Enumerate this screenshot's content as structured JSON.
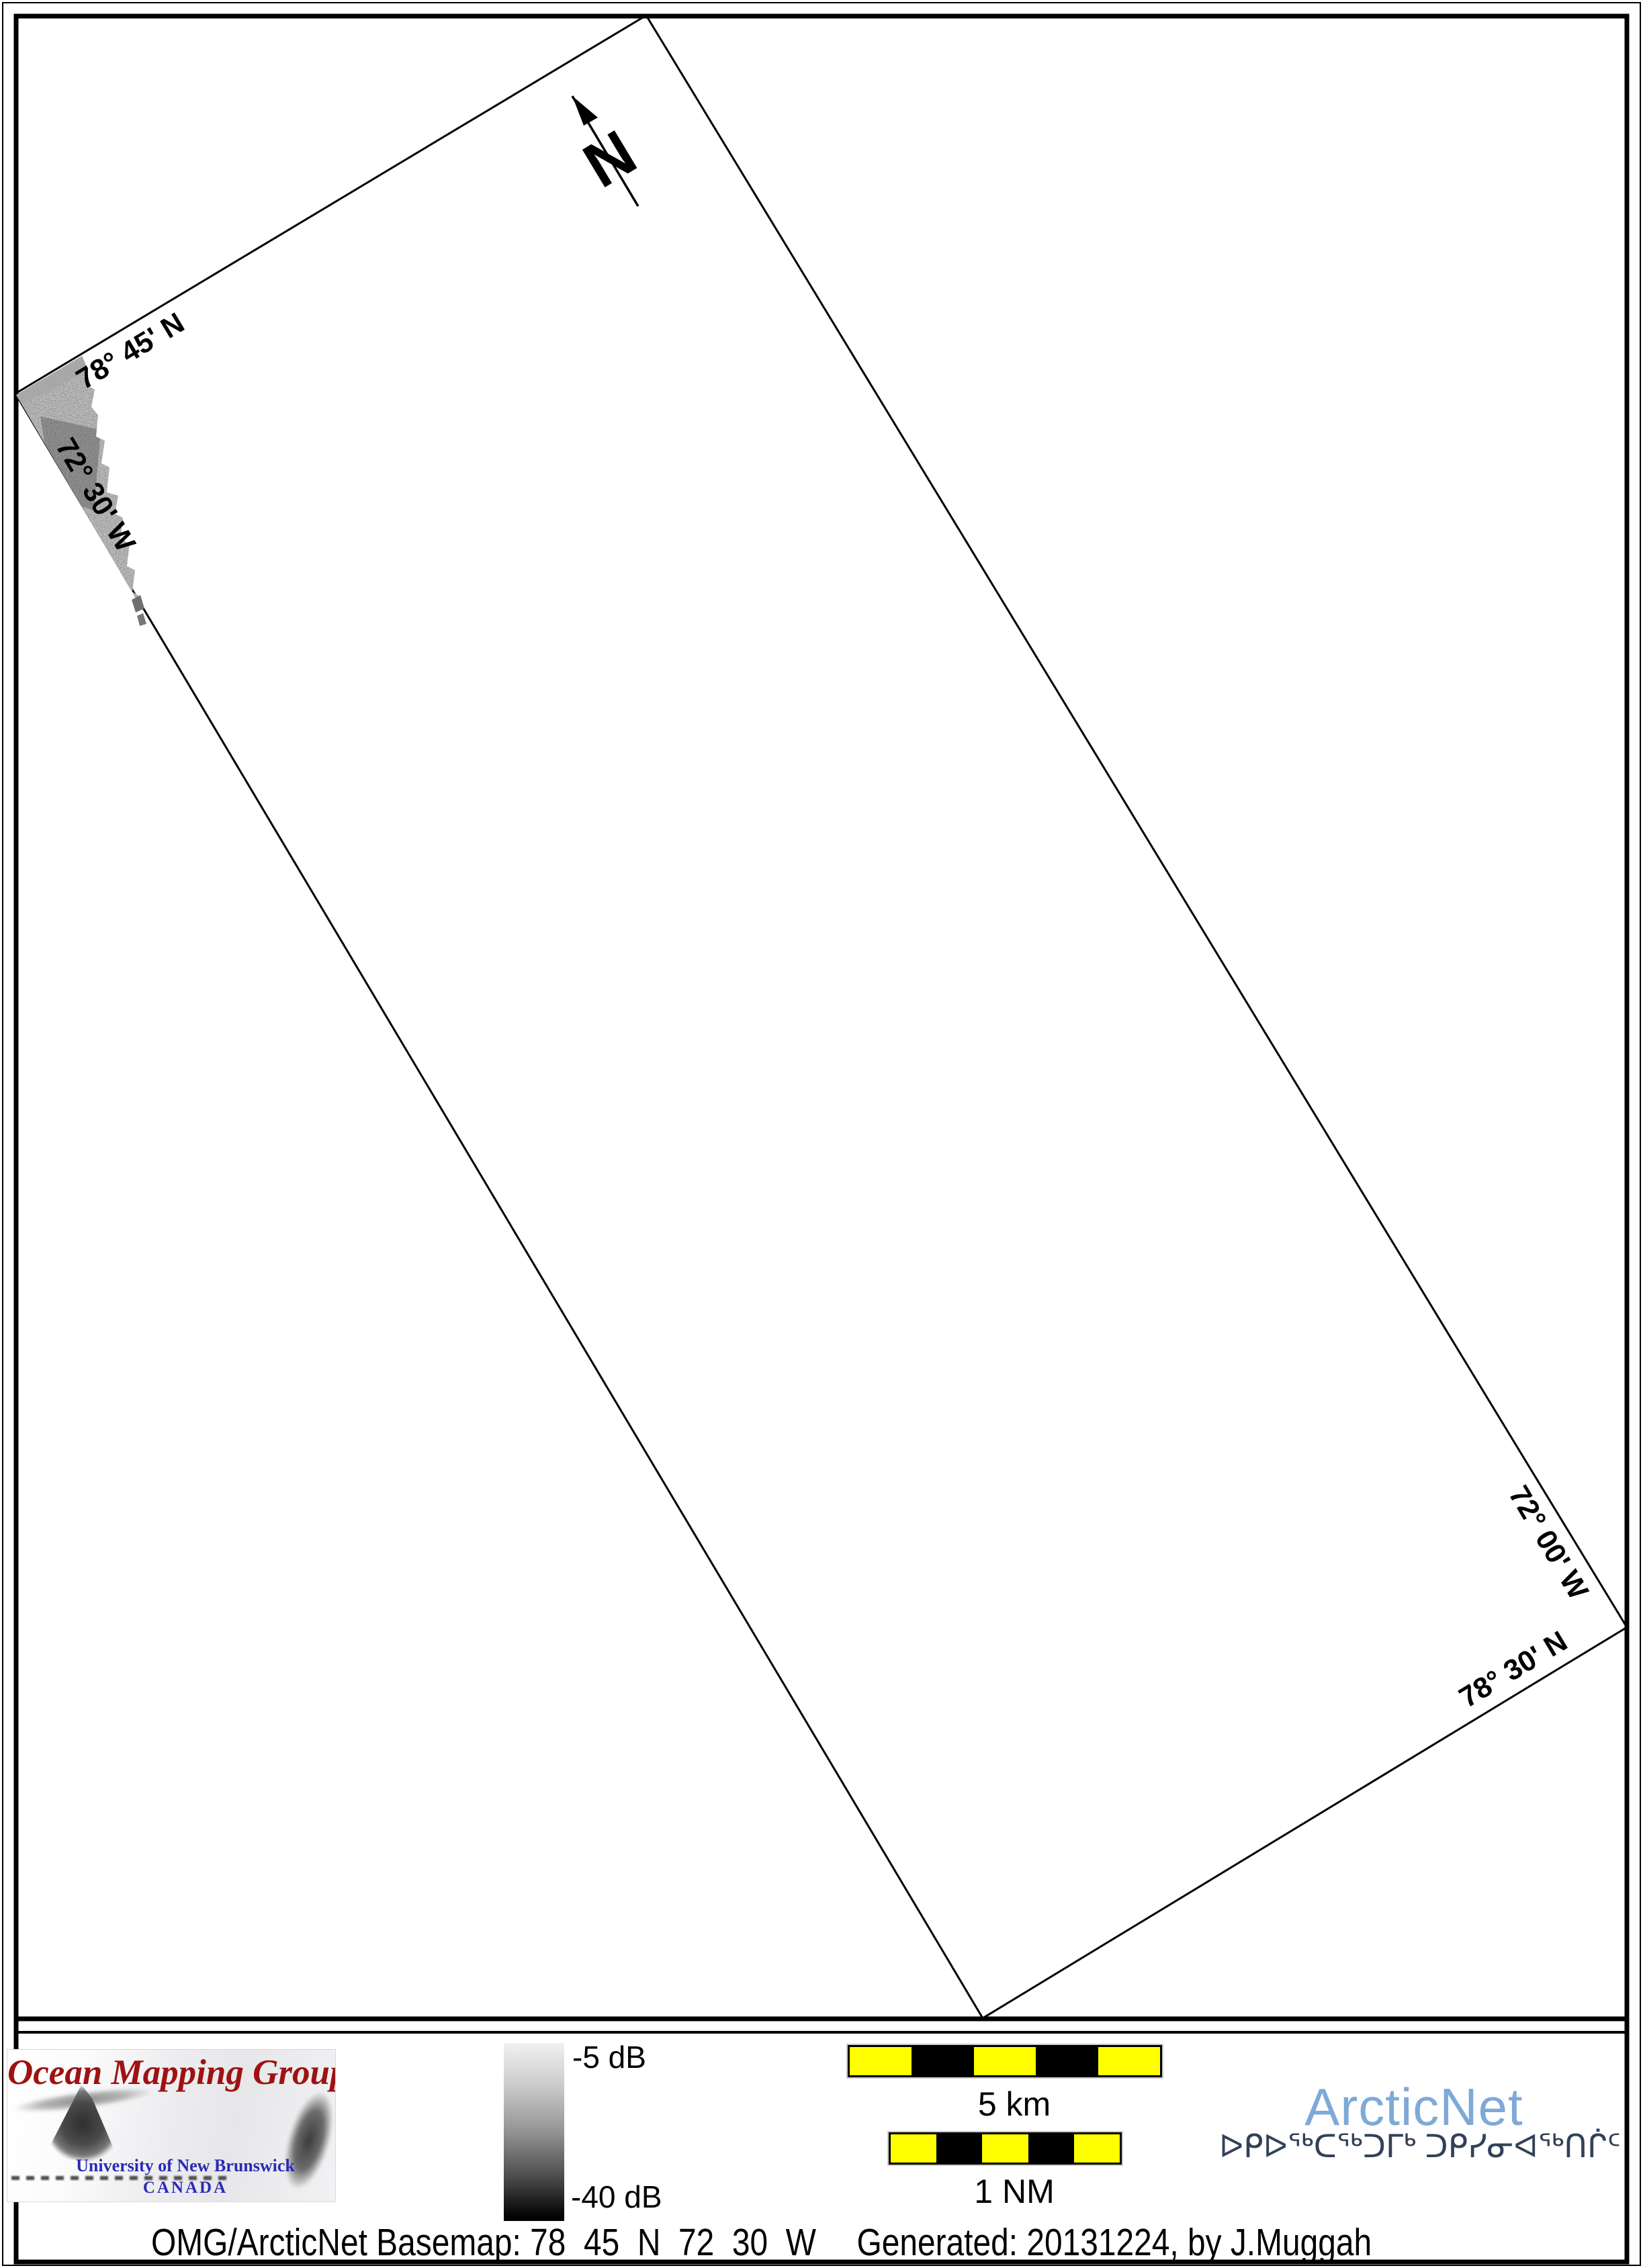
{
  "map": {
    "north_arrow": "N",
    "boundary_labels": {
      "lat_top": "78° 45' N",
      "lon_left": "72° 30' W",
      "lon_right": "72° 00' W",
      "lat_bottom": "78° 30' N"
    }
  },
  "colorbar": {
    "max_label": "-5 dB",
    "min_label": "-40 dB"
  },
  "scalebars": {
    "km": "5 km",
    "nm": "1 NM"
  },
  "omg_logo": {
    "title": "Ocean Mapping Group",
    "university": "University of New Brunswick",
    "country": "CANADA"
  },
  "arcticnet_logo": {
    "name": "ArcticNet",
    "inuktitut": "ᐅᑭᐅᖅᑕᖅᑐᒥᒃ ᑐᑭᓯᓂᐊᖅᑎᒌᑦ"
  },
  "footer": {
    "basemap": "OMG/ArcticNet Basemap: 78_45_N_72_30_W",
    "generated": "Generated: 20131224, by J.Muggah"
  },
  "colors": {
    "scalebar-yellow": "#ffff00",
    "omg-red": "#9e1212",
    "unb-blue": "#2a2ab8",
    "arcticnet-blue": "#7ea9d8",
    "inuktitut-navy": "#324158"
  }
}
